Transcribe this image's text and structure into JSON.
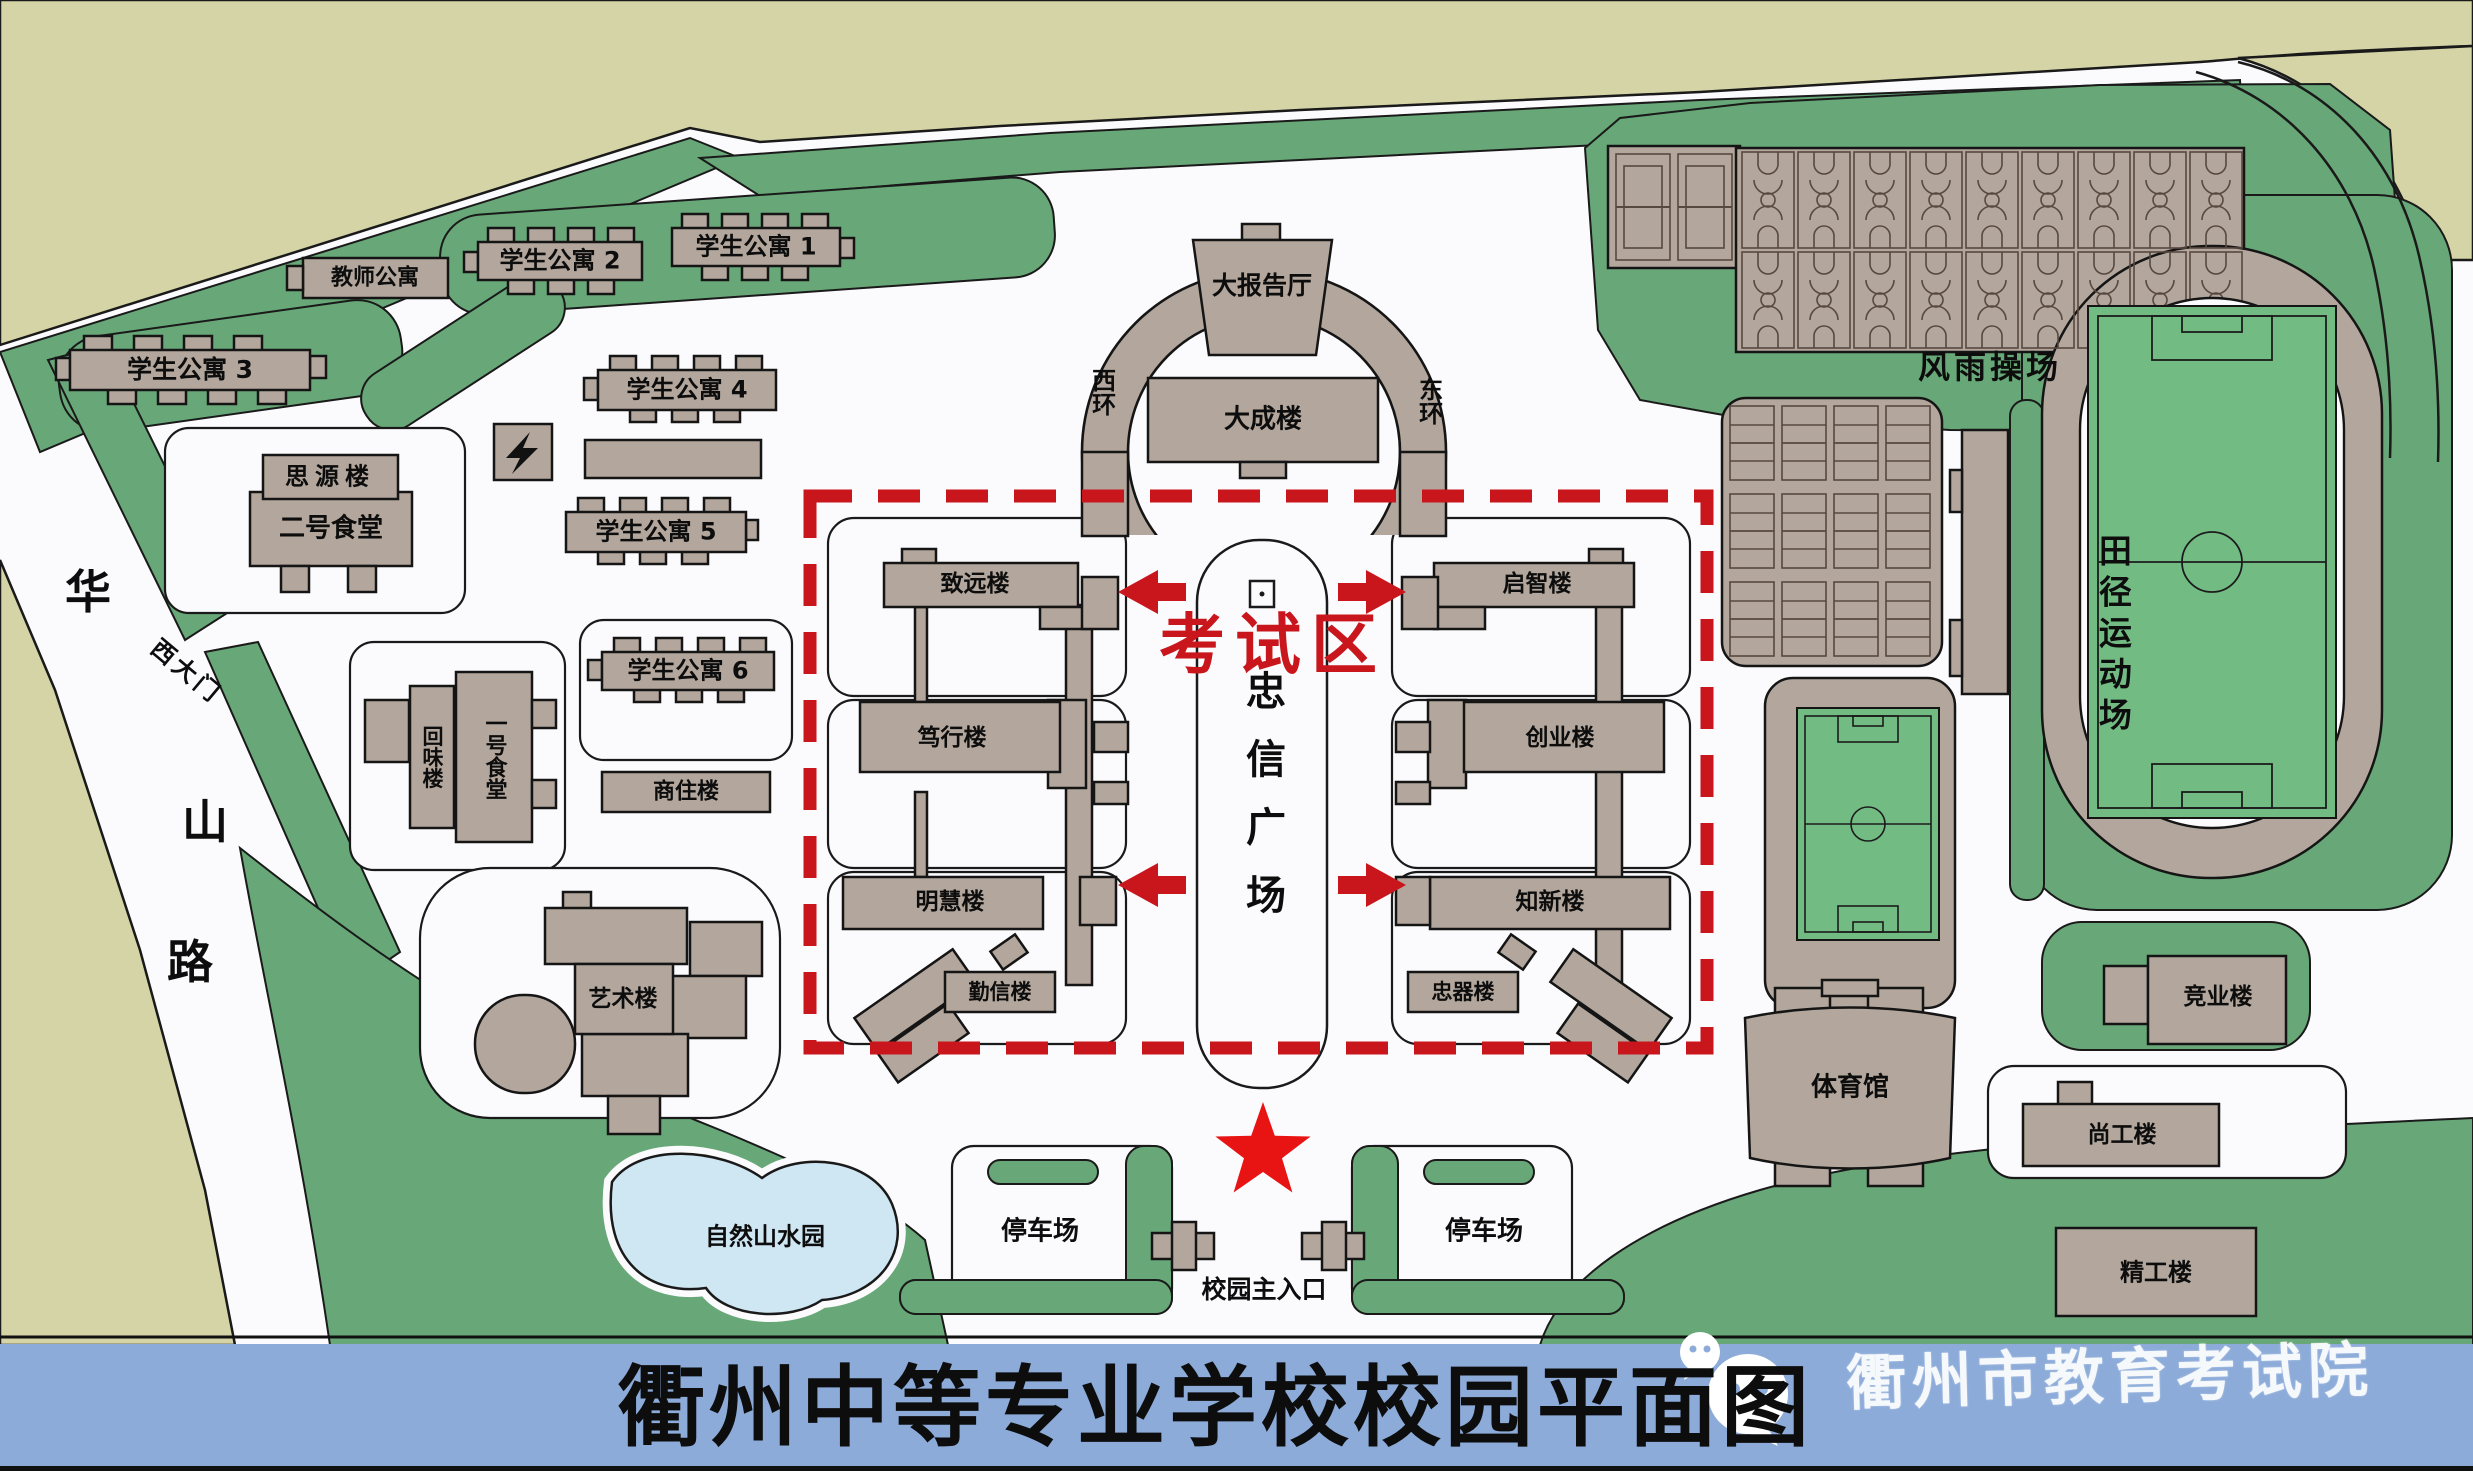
{
  "title": "衢州中等专业学校校园平面图",
  "watermark": "衢州市教育考试院",
  "exam_zone_label": "考试区",
  "plaza_label": "忠信广场",
  "road": {
    "chars": [
      "华",
      "山",
      "路"
    ],
    "west_gate": "西大门"
  },
  "entrance": {
    "label": "校园主入口",
    "parking": "停车场"
  },
  "sports": {
    "fengyu": "风雨操场",
    "track": "田径运动场",
    "garden": "自然山水园"
  },
  "buildings": {
    "teacher_apt": "教师公寓",
    "student_apt_1": "学生公寓 1",
    "student_apt_2": "学生公寓 2",
    "student_apt_3": "学生公寓 3",
    "student_apt_4": "学生公寓 4",
    "student_apt_5": "学生公寓 5",
    "student_apt_6": "学生公寓 6",
    "siyuan": "思源楼",
    "canteen2": "二号食堂",
    "huiwei": "回味楼",
    "canteen1": "一号食堂",
    "shangzhu": "商住楼",
    "yishu": "艺术楼",
    "dabaogaoting": "大报告厅",
    "dacheng": "大成楼",
    "xihuan": "西环",
    "donghuan": "东环",
    "zhiyuan": "致远楼",
    "duxing": "笃行楼",
    "minghui": "明慧楼",
    "qinxin": "勤信楼",
    "qizhi": "启智楼",
    "chuangye": "创业楼",
    "zhixin": "知新楼",
    "zhongqi": "忠器楼",
    "tiyuguan": "体育馆",
    "jingye": "竞业楼",
    "shanggong": "尚工楼",
    "jinggong": "精工楼"
  },
  "colors": {
    "accent_red": "#c9161c",
    "band_blue": "#8cabd9",
    "lawn_green": "#68a878",
    "building_tan": "#b3a79d"
  }
}
